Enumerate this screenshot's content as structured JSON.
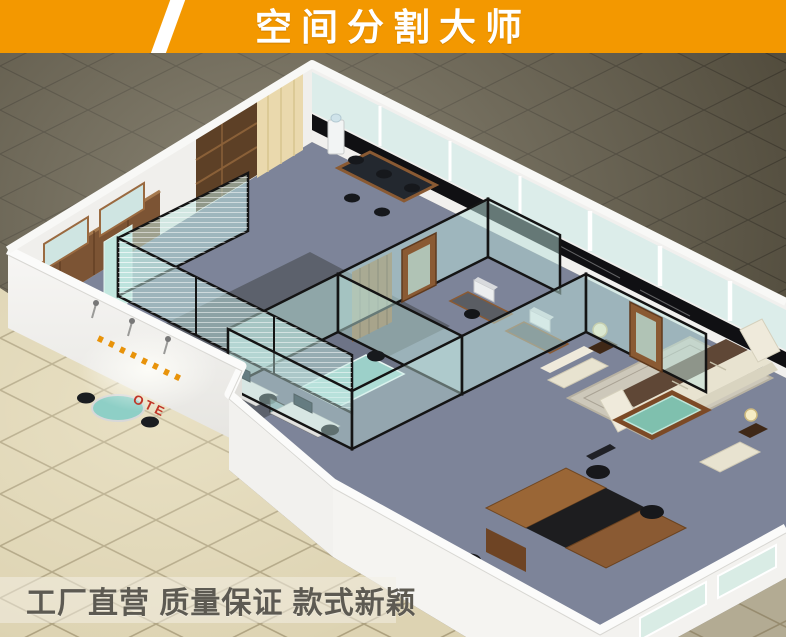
{
  "banner": {
    "title": "空间分割大师",
    "bg_color": "#f39800",
    "slash_color": "#ffffff",
    "text_color": "#ffffff"
  },
  "footer": {
    "slogan": "工厂直营 质量保证 款式新颖",
    "text_color": "#5d5a52"
  },
  "scene": {
    "logo_text": "OTE",
    "colors": {
      "logo_red": "#c03527",
      "logo_orange": "#e8930a",
      "dark_floor": "#4b4536",
      "tile_floor": "#ddd3b2",
      "carpet_blue": "#7d8499",
      "carpet_dark": "#5c616c",
      "glass": "#cfe9e5",
      "partition_frame": "#141414",
      "wood": "#7c5434",
      "wall_white": "#f4f3f1"
    }
  }
}
